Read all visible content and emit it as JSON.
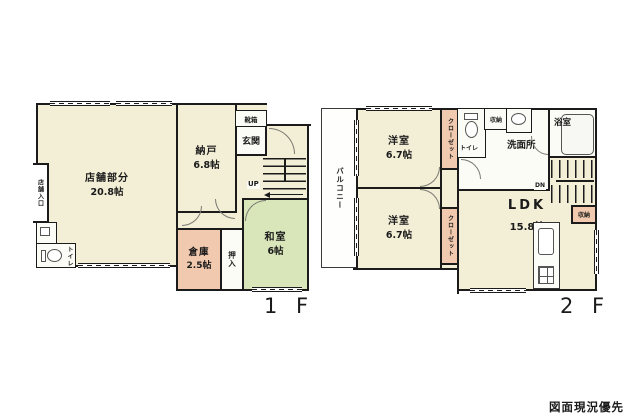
{
  "disclaimer": "図面現況優先",
  "floor1": {
    "floor_label": "1 F",
    "shop": {
      "name": "店舗部分",
      "size": "20.8帖"
    },
    "shop_entrance": "店舗入口",
    "toilet": "トイレ",
    "nando": {
      "name": "納戸",
      "size": "6.8帖"
    },
    "shoebox": "靴箱",
    "genkan": "玄関",
    "stairs_up": "UP",
    "souko": {
      "name": "倉庫",
      "size": "2.5帖"
    },
    "oshiire": "押入",
    "washitsu": {
      "name": "和室",
      "size": "6帖"
    }
  },
  "floor2": {
    "floor_label": "2 F",
    "balcony": "バルコニー",
    "yoshitsu_top": {
      "name": "洋室",
      "size": "6.7帖"
    },
    "closet_top": "クローゼット",
    "toilet": "トイレ",
    "storage_top": "収納",
    "senmenjo": "洗面所",
    "bathroom": "浴室",
    "stairs_down": "DN",
    "storage_right": "収納",
    "ldk": {
      "name": "LDK",
      "size": "15.8帖"
    },
    "yoshitsu_bottom": {
      "name": "洋室",
      "size": "6.7帖"
    },
    "closet_bottom": "クローゼット"
  },
  "colors": {
    "room_cream": "#f3efd6",
    "tatami_green": "#d9e6ba",
    "storage_pink": "#f1c9ae",
    "wall": "#1b1b1b",
    "background": "#ffffff"
  }
}
